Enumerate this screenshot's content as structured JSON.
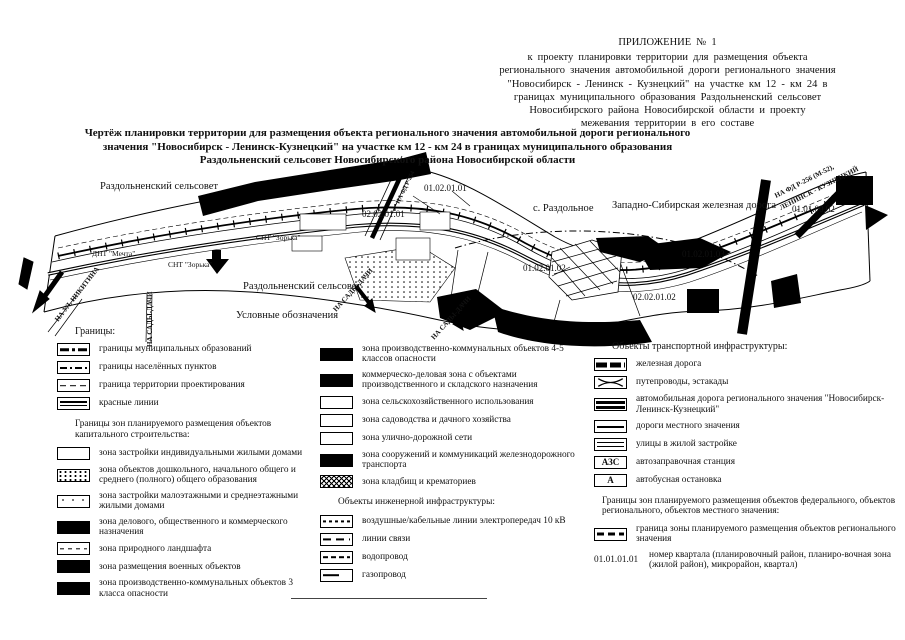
{
  "header": {
    "appendix": "ПРИЛОЖЕНИЕ № 1",
    "lines": [
      "к  проекту   планировки   территории  для  размещения  объекта",
      "регионального   значения  автомобильной  дороги  регионального  значения",
      "\"Новосибирск - Ленинск - Кузнецкий\"  на  участке км 12 - км  24  в",
      "границах  муниципального  образования  Раздольненский  сельсовет",
      "Новосибирского  района  Новосибирской  области  и  проекту",
      "межевания территории  в  его  составе"
    ]
  },
  "title": {
    "lines": [
      "Чертёж планировки  территории для размещения объекта регионального значения автомобильной  дороги регионального",
      "значения \"Новосибирск - Ленинск-Кузнецкий\" на участке км 12 - км 24 в границах муниципального образования",
      "Раздольненский сельсовет Новосибирского района Новосибирской области"
    ]
  },
  "map": {
    "labels": [
      "Раздольненский сельсовет",
      "Раздольненский сельсовет",
      "с. Раздольное",
      "Западно-Сибирская железная дорога",
      "ДНТ \"Мечта\"",
      "СНТ \"Зорька\"",
      "СНТ \"Зорька\"",
      "02.02.01.01",
      "01.02.01.01",
      "01.02.01.02",
      "02.02.01.02",
      "01.02.01.03",
      "01.01.00.02",
      "НА УЛ. НИКИТИНА",
      "НА САДЫ-ДАЧИ",
      "НА САДЫ-ДАЧИ",
      "НА САДЫ-ДАЧИ",
      "НА ФД Р-254",
      "НА ФД Р-256 (М-52),",
      "ЛЕНИНСК - КУЗНЕЦКИЙ"
    ]
  },
  "legend": {
    "heading": "Условные обозначения",
    "borders_heading": "Границы:",
    "borders": [
      "границы муниципальных образований",
      "границы населённых пунктов",
      "граница территории проектирования",
      "красные линии"
    ],
    "capital_heading": "Границы зон планируемого размещения объектов капитального строительства:",
    "capital": [
      "зона застройки индивидуальными жилыми домами",
      "зона объектов дошкольного, начального общего и среднего (полного) общего образования",
      "зона застройки малоэтажными и среднеэтажными жилыми домами",
      "зона делового, общественного и коммерческого назначения",
      "зона природного ландшафта",
      "зона размещения военных объектов",
      "зона производственно-коммунальных объектов 3 класса опасности"
    ],
    "zones2": [
      "зона производственно-коммунальных объектов 4-5 классов опасности",
      "коммерческо-деловая зона с объектами производственного и складского назначения",
      "зона сельскохозяйственного использования",
      "зона садоводства и дачного хозяйства",
      "зона улично-дорожной сети",
      "зона сооружений и коммуникаций железнодорожного транспорта",
      "зона кладбищ и крематориев"
    ],
    "engineering_heading": "Объекты инженерной инфраструктуры:",
    "engineering": [
      "воздушные/кабельные линии электропередач 10 кВ",
      "линии связи",
      "водопровод",
      "газопровод"
    ],
    "transport_heading": "Объекты транспортной инфраструктуры:",
    "transport": [
      "железная дорога",
      "путепроводы, эстакады",
      "автомобильная дорога регионального значения \"Новосибирск- Ленинск-Кузнецкий\"",
      "дороги местного значения",
      "улицы в жилой застройке",
      "автозаправочная станция",
      "автобусная остановка"
    ],
    "azs_text": "АЗС",
    "bus_text": "А",
    "federal_heading": "Границы зон планируемого размещения объектов федерального, объектов регионального, объектов местного значения:",
    "federal": [
      "граница зоны планируемого размещения объектов регионального значения"
    ],
    "quarter_number": "01.01.01.01",
    "quarter_label": "номер квартала (планировочный район, планиро-вочная зона (жилой район), микрорайон, квартал)"
  }
}
